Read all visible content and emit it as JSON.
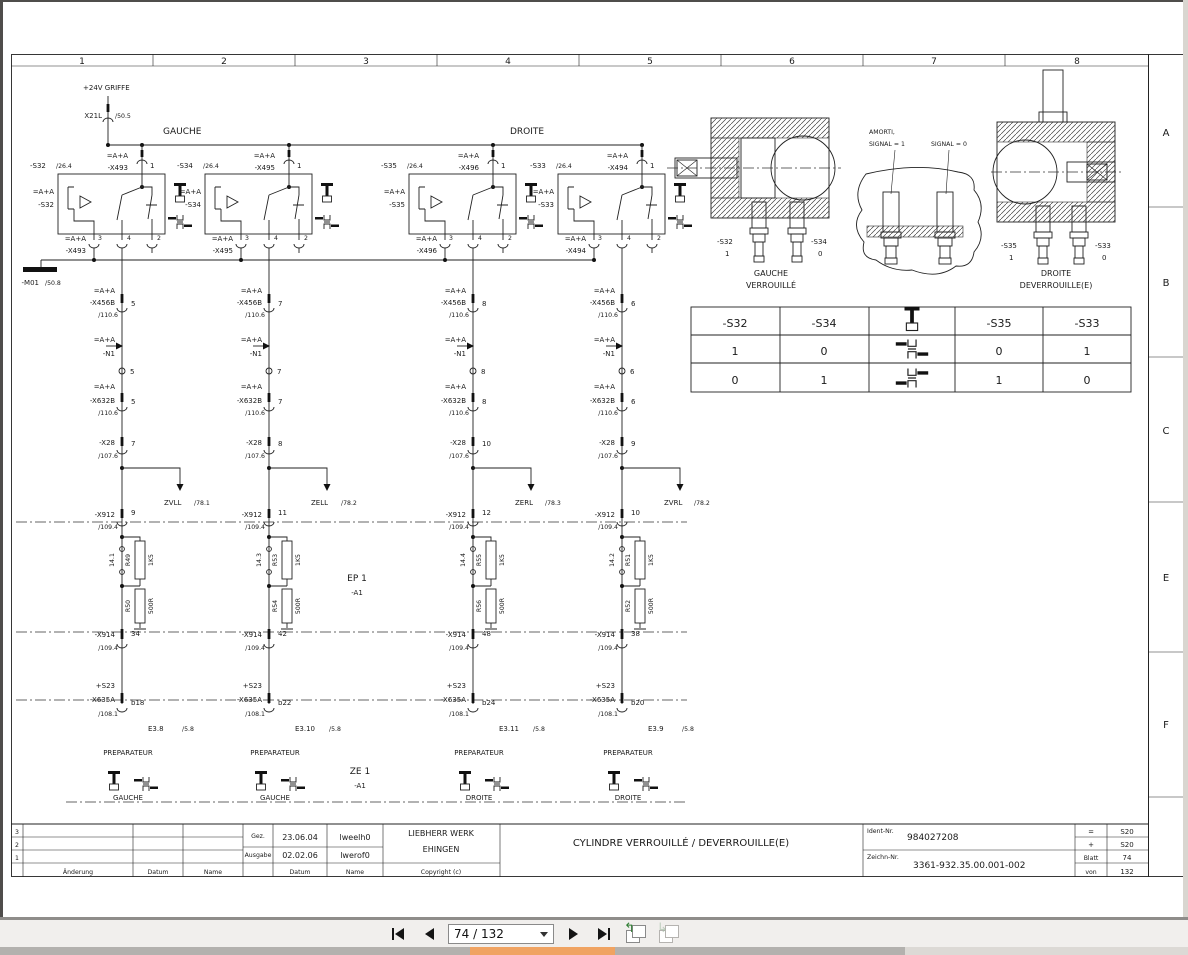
{
  "viewer": {
    "page_indicator": "74 / 132"
  },
  "drawing": {
    "frame": {
      "columns": [
        "1",
        "2",
        "3",
        "4",
        "5",
        "6",
        "7",
        "8"
      ],
      "rows": [
        "A",
        "B",
        "C",
        "E",
        "F"
      ]
    },
    "power": {
      "label": "+24V GRIFFE",
      "terminal": "X21L",
      "ref": "/50.5"
    },
    "bus": {
      "left": "GAUCHE",
      "right": "DROITE"
    },
    "ground": {
      "tag": "-M01",
      "ref": "/50.8"
    },
    "ep1": {
      "name": "EP 1",
      "tag": "-A1"
    },
    "ze1": {
      "name": "ZE 1",
      "tag": "-A1"
    },
    "common": {
      "aa": "=A+A",
      "x456b": "-X456B",
      "x456b_ref": "/110.6",
      "n1": "-N1",
      "x632b": "-X632B",
      "x632b_ref": "/110.6",
      "x28": "-X28",
      "x28_ref": "/107.6",
      "x912": "-X912",
      "x912_ref": "/109.4",
      "x914": "-X914",
      "x914_ref": "/109.4",
      "s23": "+S23",
      "x635a": "-X635A",
      "x635a_ref": "/108.1",
      "e3_ref": "/5.8",
      "prep": "PREPARATEUR",
      "r1v": "1K5",
      "r2v": "500R"
    },
    "circuits": [
      {
        "s_ref": "-S32",
        "sheet": "/26.4",
        "conn": "-X493",
        "pin_top": "1",
        "pin3": "3",
        "pin4": "4",
        "pin2": "2",
        "x456b_pin": "5",
        "n1_pin": "5",
        "x632b_pin": "5",
        "x28_pin": "7",
        "signal": "ZVLL",
        "signal_ref": "/78.1",
        "x912_pin": "9",
        "tp": "14.1",
        "r1": "R49",
        "r2": "R50",
        "x914_pin": "34",
        "x635a_pin": "b18",
        "e3": "E3.8",
        "side": "GAUCHE"
      },
      {
        "s_ref": "-S34",
        "sheet": "/26.4",
        "conn": "-X495",
        "pin_top": "1",
        "pin3": "3",
        "pin4": "4",
        "pin2": "2",
        "x456b_pin": "7",
        "n1_pin": "7",
        "x632b_pin": "7",
        "x28_pin": "8",
        "signal": "ZELL",
        "signal_ref": "/78.2",
        "x912_pin": "11",
        "tp": "14.3",
        "r1": "R53",
        "r2": "R54",
        "x914_pin": "42",
        "x635a_pin": "b22",
        "e3": "E3.10",
        "side": "GAUCHE"
      },
      {
        "s_ref": "-S35",
        "sheet": "/26.4",
        "conn": "-X496",
        "pin_top": "1",
        "pin3": "3",
        "pin4": "4",
        "pin2": "2",
        "x456b_pin": "8",
        "n1_pin": "8",
        "x632b_pin": "8",
        "x28_pin": "10",
        "signal": "ZERL",
        "signal_ref": "/78.3",
        "x912_pin": "12",
        "tp": "14.4",
        "r1": "R55",
        "r2": "R56",
        "x914_pin": "48",
        "x635a_pin": "b24",
        "e3": "E3.11",
        "side": "DROITE"
      },
      {
        "s_ref": "-S33",
        "sheet": "/26.4",
        "conn": "-X494",
        "pin_top": "1",
        "pin3": "3",
        "pin4": "4",
        "pin2": "2",
        "x456b_pin": "6",
        "n1_pin": "6",
        "x632b_pin": "6",
        "x28_pin": "9",
        "signal": "ZVRL",
        "signal_ref": "/78.2",
        "x912_pin": "10",
        "tp": "14.2",
        "r1": "R51",
        "r2": "R52",
        "x914_pin": "38",
        "x635a_pin": "b20",
        "e3": "E3.9",
        "side": "DROITE"
      }
    ],
    "cylinders": {
      "left": {
        "s1": "-S32",
        "v1": "1",
        "s2": "-S34",
        "v2": "0",
        "cap1": "GAUCHE",
        "cap2": "VERROUILLÉ"
      },
      "middle": {
        "l1": "AMORTI,",
        "l2": "SIGNAL = 1",
        "l3": "SIGNAL = 0"
      },
      "right": {
        "s1": "-S35",
        "v1": "1",
        "s2": "-S33",
        "v2": "0",
        "cap1": "DROITE",
        "cap2": "DEVERROUILLE(E)"
      }
    },
    "truth_table": {
      "headers": [
        "-S32",
        "-S34",
        "-S35",
        "-S33"
      ],
      "rows": [
        [
          "1",
          "0",
          "0",
          "1"
        ],
        [
          "0",
          "1",
          "1",
          "0"
        ]
      ]
    },
    "title_block": {
      "rev_rows": [
        "3",
        "2",
        "1"
      ],
      "rev_cols": [
        "Änderung",
        "Datum",
        "Name"
      ],
      "gez_label": "Gez.",
      "gez_date": "23.06.04",
      "gez_name": "lweelh0",
      "ausgabe_label": "Ausgabe",
      "ausgabe_date": "02.02.06",
      "ausgabe_name": "lwerof0",
      "datum": "Datum",
      "name": "Name",
      "company1": "LIEBHERR WERK",
      "company2": "EHINGEN",
      "copyright": "Copyright (c)",
      "title": "CYLINDRE VERROUILLÉ / DEVERROUILLE(E)",
      "ident_label": "Ident-Nr.",
      "ident": "984027208",
      "zeichn_label": "Zeichn-Nr.",
      "zeichn": "3361-932.35.00.001-002",
      "eq_label": "=",
      "eq": "S20",
      "plus_label": "+",
      "plus": "S20",
      "blatt_label": "Blatt",
      "blatt": "74",
      "von_label": "von",
      "von": "132"
    }
  }
}
